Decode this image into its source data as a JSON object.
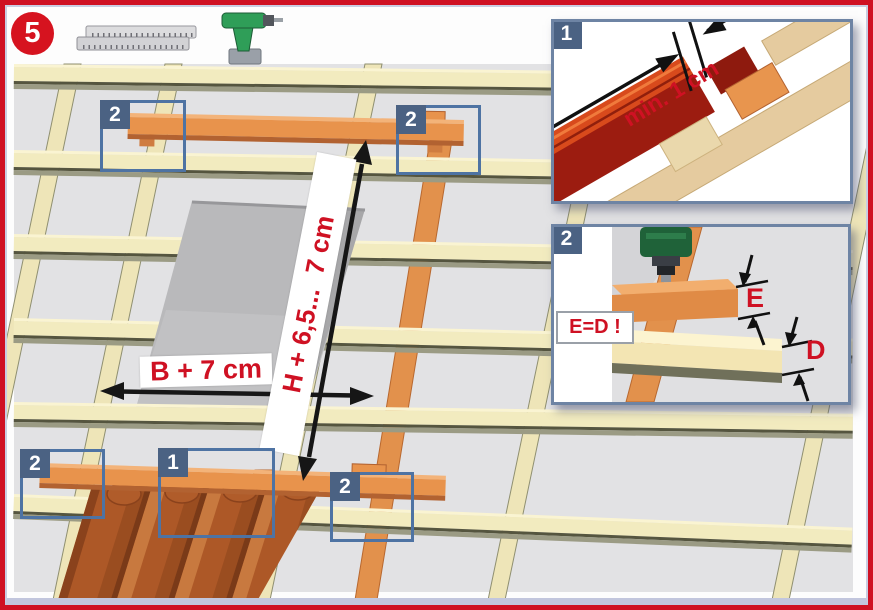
{
  "sheet": {
    "step_number": "5",
    "tools": [
      {
        "icon": "folding-ruler-icon"
      },
      {
        "icon": "cordless-drill-icon"
      }
    ]
  },
  "diagram": {
    "width_label": "B + 7 cm",
    "height_label": "H + 6,5...  7 cm",
    "callouts": [
      {
        "number": "2",
        "position": "head-batten-left"
      },
      {
        "number": "2",
        "position": "head-batten-right"
      },
      {
        "number": "2",
        "position": "foot-batten-left"
      },
      {
        "number": "1",
        "position": "tiles"
      },
      {
        "number": "2",
        "position": "foot-batten-right"
      }
    ]
  },
  "insets": [
    {
      "number": "1",
      "dimension_label": "min. 1 cm"
    },
    {
      "number": "2",
      "note": "E=D !",
      "upper_dimension": "E",
      "lower_dimension": "D"
    }
  ],
  "colors": {
    "accent_red": "#cf1123",
    "callout_blue": "#4e73a3",
    "tag_blue": "#4b6283",
    "batten_cream": "#f2ebbf",
    "batten_orange": "#e8934c",
    "tile_terracotta": "#ad5827",
    "underlay_gray": "#e2e2e4"
  }
}
